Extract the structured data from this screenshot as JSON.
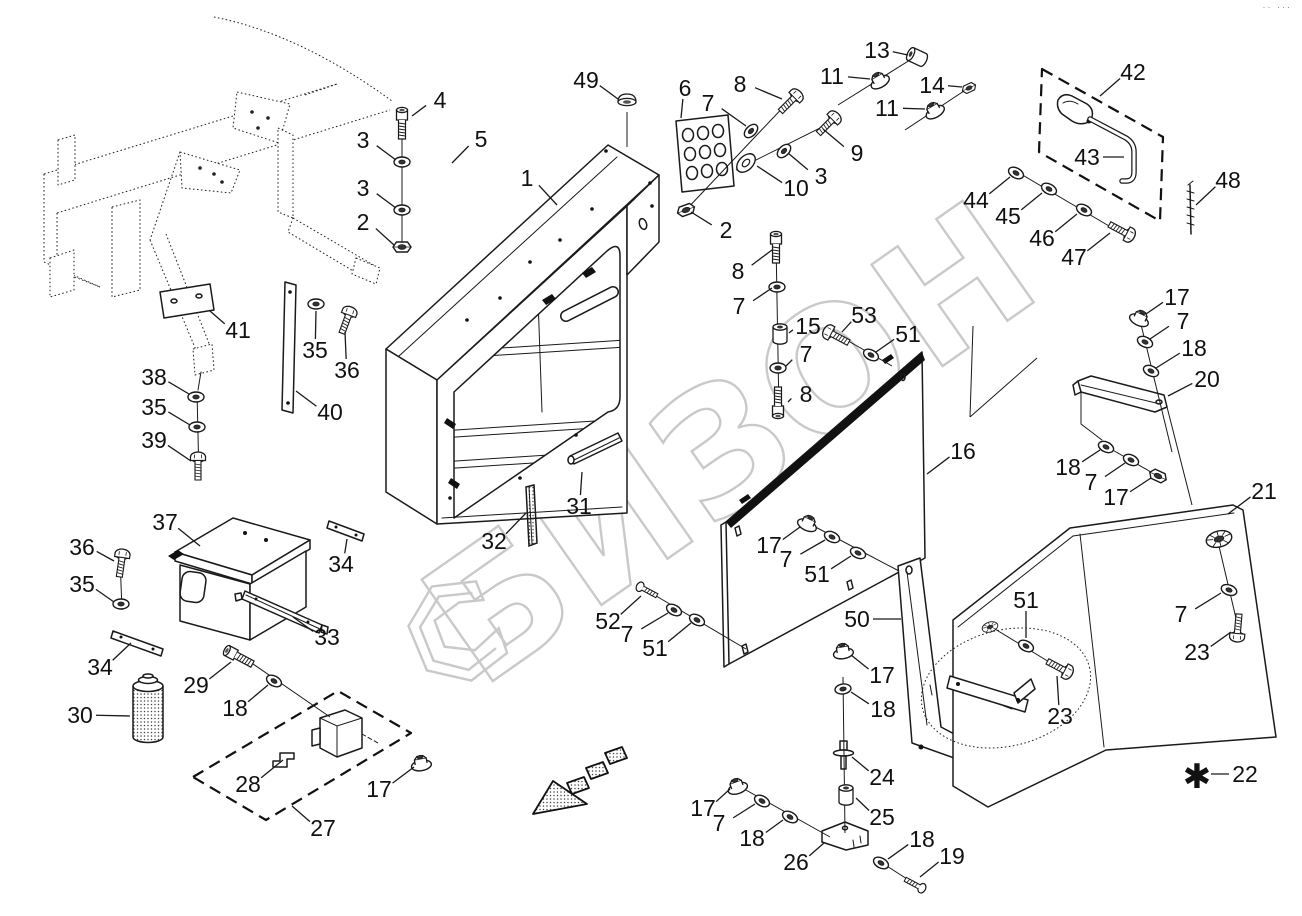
{
  "colors": {
    "ink": "#1a1a1a",
    "watermark": "#c9c9c9",
    "background": "#ffffff"
  },
  "watermark": {
    "text": "БИЗОН"
  },
  "corner_mark": "·· ···",
  "footnote": {
    "marker": "✱"
  },
  "diagram": {
    "callouts": [
      {
        "n": "4",
        "x": 440,
        "y": 100,
        "tx": 412,
        "ty": 116
      },
      {
        "n": "3",
        "x": 363,
        "y": 140,
        "tx": 396,
        "ty": 160
      },
      {
        "n": "3",
        "x": 363,
        "y": 188,
        "tx": 396,
        "ty": 208
      },
      {
        "n": "2",
        "x": 363,
        "y": 222,
        "tx": 394,
        "ty": 245
      },
      {
        "n": "5",
        "x": 481,
        "y": 139,
        "tx": 452,
        "ty": 163
      },
      {
        "n": "49",
        "x": 586,
        "y": 80,
        "tx": 618,
        "ty": 99
      },
      {
        "n": "1",
        "x": 527,
        "y": 178,
        "tx": 557,
        "ty": 205
      },
      {
        "n": "6",
        "x": 685,
        "y": 88,
        "tx": 681,
        "ty": 118
      },
      {
        "n": "7",
        "x": 708,
        "y": 103,
        "tx": 746,
        "ty": 126
      },
      {
        "n": "8",
        "x": 740,
        "y": 84,
        "tx": 782,
        "ty": 99
      },
      {
        "n": "13",
        "x": 877,
        "y": 50,
        "tx": 908,
        "ty": 55
      },
      {
        "n": "11",
        "x": 832,
        "y": 76,
        "tx": 870,
        "ty": 79
      },
      {
        "n": "14",
        "x": 932,
        "y": 85,
        "tx": 962,
        "ty": 87
      },
      {
        "n": "11",
        "x": 887,
        "y": 108,
        "tx": 925,
        "ty": 109
      },
      {
        "n": "9",
        "x": 857,
        "y": 153,
        "tx": 823,
        "ty": 129
      },
      {
        "n": "3",
        "x": 821,
        "y": 176,
        "tx": 788,
        "ty": 153
      },
      {
        "n": "10",
        "x": 796,
        "y": 188,
        "tx": 757,
        "ty": 166
      },
      {
        "n": "2",
        "x": 726,
        "y": 230,
        "tx": 691,
        "ty": 212
      },
      {
        "n": "8",
        "x": 738,
        "y": 271,
        "tx": 772,
        "ty": 250
      },
      {
        "n": "7",
        "x": 739,
        "y": 306,
        "tx": 772,
        "ty": 288
      },
      {
        "n": "15",
        "x": 808,
        "y": 326,
        "tx": 789,
        "ty": 333
      },
      {
        "n": "53",
        "x": 864,
        "y": 315,
        "tx": 842,
        "ty": 332
      },
      {
        "n": "51",
        "x": 908,
        "y": 334,
        "tx": 876,
        "ty": 352
      },
      {
        "n": "7",
        "x": 806,
        "y": 354,
        "tx": 786,
        "ty": 366
      },
      {
        "n": "8",
        "x": 806,
        "y": 394,
        "tx": 788,
        "ty": 402
      },
      {
        "n": "42",
        "x": 1133,
        "y": 72,
        "tx": 1100,
        "ty": 96
      },
      {
        "n": "43",
        "x": 1087,
        "y": 157,
        "tx": 1124,
        "ty": 157
      },
      {
        "n": "48",
        "x": 1228,
        "y": 180,
        "tx": 1196,
        "ty": 205
      },
      {
        "n": "44",
        "x": 976,
        "y": 200,
        "tx": 1010,
        "ty": 177
      },
      {
        "n": "45",
        "x": 1008,
        "y": 216,
        "tx": 1042,
        "ty": 193
      },
      {
        "n": "46",
        "x": 1042,
        "y": 238,
        "tx": 1077,
        "ty": 214
      },
      {
        "n": "47",
        "x": 1074,
        "y": 257,
        "tx": 1110,
        "ty": 233
      },
      {
        "n": "17",
        "x": 1177,
        "y": 297,
        "tx": 1146,
        "ty": 314
      },
      {
        "n": "7",
        "x": 1183,
        "y": 321,
        "tx": 1150,
        "ty": 339
      },
      {
        "n": "18",
        "x": 1194,
        "y": 348,
        "tx": 1156,
        "ty": 368
      },
      {
        "n": "20",
        "x": 1207,
        "y": 379,
        "tx": 1168,
        "ty": 396
      },
      {
        "n": "18",
        "x": 1068,
        "y": 467,
        "tx": 1100,
        "ty": 450
      },
      {
        "n": "7",
        "x": 1091,
        "y": 482,
        "tx": 1125,
        "ty": 463
      },
      {
        "n": "17",
        "x": 1116,
        "y": 497,
        "tx": 1151,
        "ty": 478
      },
      {
        "n": "21",
        "x": 1264,
        "y": 491,
        "tx": 1228,
        "ty": 514
      },
      {
        "n": "16",
        "x": 963,
        "y": 451,
        "tx": 927,
        "ty": 474
      },
      {
        "n": "41",
        "x": 238,
        "y": 330,
        "tx": 210,
        "ty": 311
      },
      {
        "n": "35",
        "x": 315,
        "y": 350,
        "tx": 316,
        "ty": 311
      },
      {
        "n": "36",
        "x": 347,
        "y": 370,
        "tx": 345,
        "ty": 332
      },
      {
        "n": "40",
        "x": 330,
        "y": 412,
        "tx": 296,
        "ty": 391
      },
      {
        "n": "38",
        "x": 154,
        "y": 377,
        "tx": 189,
        "ty": 394
      },
      {
        "n": "35",
        "x": 154,
        "y": 407,
        "tx": 190,
        "ty": 425
      },
      {
        "n": "39",
        "x": 154,
        "y": 440,
        "tx": 191,
        "ty": 461
      },
      {
        "n": "37",
        "x": 165,
        "y": 522,
        "tx": 200,
        "ty": 546
      },
      {
        "n": "34",
        "x": 341,
        "y": 564,
        "tx": 347,
        "ty": 539
      },
      {
        "n": "33",
        "x": 327,
        "y": 637,
        "tx": 293,
        "ty": 617
      },
      {
        "n": "36",
        "x": 82,
        "y": 547,
        "tx": 114,
        "ty": 561
      },
      {
        "n": "35",
        "x": 82,
        "y": 584,
        "tx": 114,
        "ty": 602
      },
      {
        "n": "34",
        "x": 100,
        "y": 667,
        "tx": 131,
        "ty": 643
      },
      {
        "n": "30",
        "x": 80,
        "y": 715,
        "tx": 130,
        "ty": 716
      },
      {
        "n": "29",
        "x": 196,
        "y": 685,
        "tx": 231,
        "ty": 662
      },
      {
        "n": "18",
        "x": 235,
        "y": 708,
        "tx": 268,
        "ty": 685
      },
      {
        "n": "28",
        "x": 248,
        "y": 784,
        "tx": 283,
        "ty": 760
      },
      {
        "n": "17",
        "x": 379,
        "y": 789,
        "tx": 414,
        "ty": 767
      },
      {
        "n": "27",
        "x": 323,
        "y": 828,
        "tx": 292,
        "ty": 806
      },
      {
        "n": "32",
        "x": 494,
        "y": 541,
        "tx": 526,
        "ty": 513
      },
      {
        "n": "31",
        "x": 579,
        "y": 506,
        "tx": 582,
        "ty": 472
      },
      {
        "n": "52",
        "x": 608,
        "y": 621,
        "tx": 641,
        "ty": 596
      },
      {
        "n": "7",
        "x": 627,
        "y": 634,
        "tx": 668,
        "ty": 613
      },
      {
        "n": "51",
        "x": 655,
        "y": 648,
        "tx": 691,
        "ty": 623
      },
      {
        "n": "17",
        "x": 769,
        "y": 545,
        "tx": 800,
        "ty": 527
      },
      {
        "n": "7",
        "x": 786,
        "y": 559,
        "tx": 825,
        "ty": 540
      },
      {
        "n": "51",
        "x": 817,
        "y": 574,
        "tx": 851,
        "ty": 556
      },
      {
        "n": "50",
        "x": 857,
        "y": 619,
        "tx": 901,
        "ty": 619
      },
      {
        "n": "17",
        "x": 882,
        "y": 675,
        "tx": 851,
        "ty": 655
      },
      {
        "n": "18",
        "x": 883,
        "y": 709,
        "tx": 851,
        "ty": 692
      },
      {
        "n": "24",
        "x": 882,
        "y": 777,
        "tx": 852,
        "ty": 757
      },
      {
        "n": "25",
        "x": 882,
        "y": 817,
        "tx": 856,
        "ty": 798
      },
      {
        "n": "17",
        "x": 703,
        "y": 808,
        "tx": 730,
        "ty": 789
      },
      {
        "n": "7",
        "x": 719,
        "y": 823,
        "tx": 755,
        "ty": 804
      },
      {
        "n": "18",
        "x": 752,
        "y": 838,
        "tx": 783,
        "ty": 820
      },
      {
        "n": "26",
        "x": 796,
        "y": 862,
        "tx": 824,
        "ty": 843
      },
      {
        "n": "18",
        "x": 922,
        "y": 839,
        "tx": 888,
        "ty": 859
      },
      {
        "n": "19",
        "x": 952,
        "y": 856,
        "tx": 920,
        "ty": 877
      },
      {
        "n": "51",
        "x": 1026,
        "y": 600,
        "tx": 1026,
        "ty": 638
      },
      {
        "n": "23",
        "x": 1060,
        "y": 716,
        "tx": 1057,
        "ty": 676
      },
      {
        "n": "7",
        "x": 1181,
        "y": 614,
        "tx": 1221,
        "ty": 593
      },
      {
        "n": "23",
        "x": 1197,
        "y": 652,
        "tx": 1231,
        "ty": 632
      },
      {
        "n": "22",
        "x": 1245,
        "y": 774,
        "tx": 1211,
        "ty": 774
      }
    ],
    "hardware": [
      {
        "i": "bolt",
        "x": 402,
        "y": 126,
        "r": 0
      },
      {
        "i": "washer",
        "x": 402,
        "y": 162,
        "r": 0
      },
      {
        "i": "washer",
        "x": 402,
        "y": 210,
        "r": 0
      },
      {
        "i": "nut",
        "x": 402,
        "y": 247,
        "r": 0
      },
      {
        "i": "screw",
        "x": 789,
        "y": 103,
        "r": 45
      },
      {
        "i": "washer",
        "x": 751,
        "y": 131,
        "r": -45
      },
      {
        "i": "screw",
        "x": 827,
        "y": 125,
        "r": 45
      },
      {
        "i": "washer",
        "x": 784,
        "y": 151,
        "r": -45
      },
      {
        "i": "washer-lg",
        "x": 746,
        "y": 163,
        "r": -45
      },
      {
        "i": "nut",
        "x": 686,
        "y": 210,
        "r": -20
      },
      {
        "i": "spacer",
        "x": 917,
        "y": 57,
        "r": -65
      },
      {
        "i": "flange-nut",
        "x": 879,
        "y": 80,
        "r": -30
      },
      {
        "i": "nut",
        "x": 969,
        "y": 88,
        "r": -25,
        "s": 0.8
      },
      {
        "i": "flange-nut",
        "x": 934,
        "y": 110,
        "r": -30
      },
      {
        "i": "plug",
        "x": 627,
        "y": 102,
        "r": 0
      },
      {
        "i": "bolt",
        "x": 776,
        "y": 250,
        "r": 0
      },
      {
        "i": "washer",
        "x": 777,
        "y": 287,
        "r": 0
      },
      {
        "i": "spacer",
        "x": 780,
        "y": 334,
        "r": 0
      },
      {
        "i": "washer",
        "x": 778,
        "y": 368,
        "r": 0
      },
      {
        "i": "bolt",
        "x": 778,
        "y": 400,
        "r": 180
      },
      {
        "i": "screw",
        "x": 838,
        "y": 337,
        "r": -62
      },
      {
        "i": "washer",
        "x": 871,
        "y": 355,
        "r": 28
      },
      {
        "i": "washer",
        "x": 1016,
        "y": 173,
        "r": 28
      },
      {
        "i": "washer",
        "x": 1049,
        "y": 189,
        "r": 28
      },
      {
        "i": "washer",
        "x": 1084,
        "y": 210,
        "r": 28
      },
      {
        "i": "screw",
        "x": 1120,
        "y": 230,
        "r": 118
      },
      {
        "i": "flange-nut",
        "x": 1140,
        "y": 318,
        "r": 25
      },
      {
        "i": "washer",
        "x": 1145,
        "y": 342,
        "r": 25
      },
      {
        "i": "washer",
        "x": 1151,
        "y": 371,
        "r": 25
      },
      {
        "i": "washer",
        "x": 1106,
        "y": 447,
        "r": 25
      },
      {
        "i": "washer",
        "x": 1131,
        "y": 460,
        "r": 25
      },
      {
        "i": "nut",
        "x": 1158,
        "y": 476,
        "r": 25
      },
      {
        "i": "flange-nut",
        "x": 808,
        "y": 523,
        "r": 25
      },
      {
        "i": "washer",
        "x": 832,
        "y": 537,
        "r": 25
      },
      {
        "i": "washer",
        "x": 858,
        "y": 553,
        "r": 25
      },
      {
        "i": "screw-sm",
        "x": 648,
        "y": 591,
        "r": -62
      },
      {
        "i": "washer",
        "x": 674,
        "y": 610,
        "r": 28
      },
      {
        "i": "washer",
        "x": 697,
        "y": 620,
        "r": 28
      },
      {
        "i": "flange-nut",
        "x": 843,
        "y": 651,
        "r": -10
      },
      {
        "i": "washer",
        "x": 843,
        "y": 689,
        "r": -8
      },
      {
        "i": "spacer",
        "x": 846,
        "y": 795,
        "r": 0
      },
      {
        "i": "flange-nut",
        "x": 737,
        "y": 786,
        "r": -20
      },
      {
        "i": "washer",
        "x": 762,
        "y": 801,
        "r": 28
      },
      {
        "i": "washer",
        "x": 790,
        "y": 817,
        "r": 28
      },
      {
        "i": "washer",
        "x": 881,
        "y": 863,
        "r": 28
      },
      {
        "i": "screw-sm",
        "x": 914,
        "y": 884,
        "r": 118
      },
      {
        "i": "washer",
        "x": 1026,
        "y": 646,
        "r": 28
      },
      {
        "i": "screw",
        "x": 1058,
        "y": 667,
        "r": 118
      },
      {
        "i": "grommet",
        "x": 990,
        "y": 627,
        "r": -18,
        "s": 0.62
      },
      {
        "i": "grommet",
        "x": 1219,
        "y": 539,
        "r": -15
      },
      {
        "i": "washer",
        "x": 1229,
        "y": 590,
        "r": 20
      },
      {
        "i": "screw",
        "x": 1238,
        "y": 626,
        "r": 185
      },
      {
        "i": "washer",
        "x": 316,
        "y": 304,
        "r": 0
      },
      {
        "i": "screw",
        "x": 346,
        "y": 322,
        "r": 20
      },
      {
        "i": "washer",
        "x": 196,
        "y": 397,
        "r": 0
      },
      {
        "i": "washer",
        "x": 197,
        "y": 427,
        "r": 0
      },
      {
        "i": "screw",
        "x": 198,
        "y": 468,
        "r": 0
      },
      {
        "i": "screw",
        "x": 121,
        "y": 565,
        "r": 8
      },
      {
        "i": "washer",
        "x": 121,
        "y": 604,
        "r": 0
      },
      {
        "i": "bolt",
        "x": 241,
        "y": 658,
        "r": -62
      },
      {
        "i": "washer",
        "x": 274,
        "y": 681,
        "r": 28
      },
      {
        "i": "flange-nut",
        "x": 421,
        "y": 763,
        "r": -10
      }
    ]
  }
}
